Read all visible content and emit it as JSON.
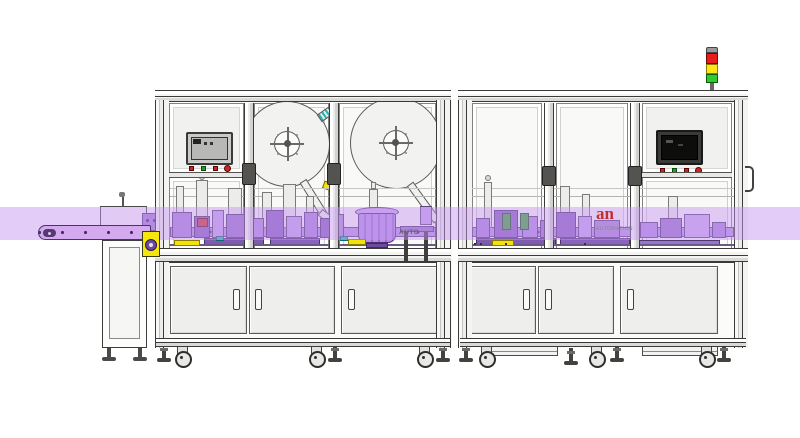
{
  "illustration": {
    "watermarks": {
      "machine_text": "AUTO",
      "logo_text": "an",
      "logo_caption": "AUTOMATION"
    },
    "stack_light": {
      "segments": [
        {
          "name": "red-light",
          "color": "#ea1c1c"
        },
        {
          "name": "yellow-light",
          "color": "#ffe416"
        },
        {
          "name": "green-light",
          "color": "#2ecc2e"
        }
      ]
    },
    "hmi_panels": [
      {
        "position": "left",
        "screen": "gray-lcd",
        "buttons": [
          "red-square",
          "green-square",
          "red-square",
          "red-circle"
        ]
      },
      {
        "position": "right",
        "screen": "black-lcd",
        "buttons": [
          "red-square",
          "green-square",
          "red-square",
          "red-circle"
        ]
      }
    ],
    "label_reels": {
      "count": 2
    },
    "highlight_band": {
      "color": "rgba(196,150,240,0.48)"
    },
    "accents": {
      "machinery_purple": "#a983d9",
      "gearbox_yellow": "#f6e70b",
      "green_fixture": "#3aa83a",
      "teal_fixture": "#2fb3b3",
      "red_fixture": "#cf3434"
    }
  }
}
